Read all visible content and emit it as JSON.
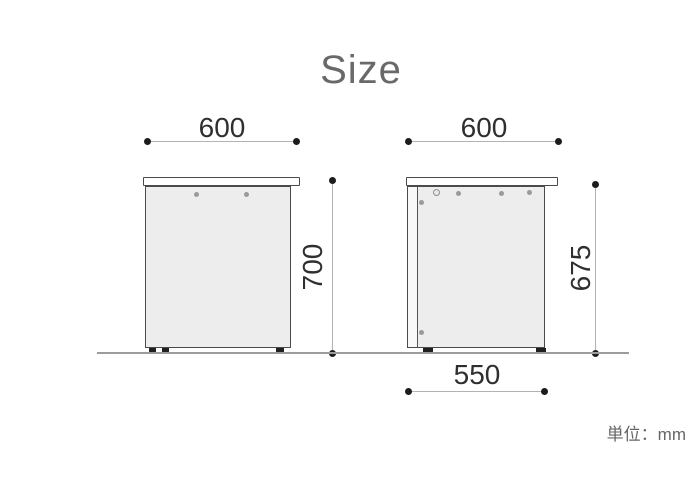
{
  "title": "Size",
  "unit_label": "単位：mm",
  "views": {
    "front": {
      "width": "600",
      "height": "700"
    },
    "side": {
      "width": "600",
      "height": "675",
      "depth": "550"
    }
  },
  "colors": {
    "title_text": "#696969",
    "dimension_text": "#2f2f2f",
    "dimension_line": "#b3b3b3",
    "endpoint_dot": "#1c1c1c",
    "panel_outline": "#4a4a4a",
    "panel_fill": "#ededed",
    "tabletop_fill": "#ffffff",
    "ground_line": "#9c9c9c",
    "unit_text": "#666666"
  }
}
